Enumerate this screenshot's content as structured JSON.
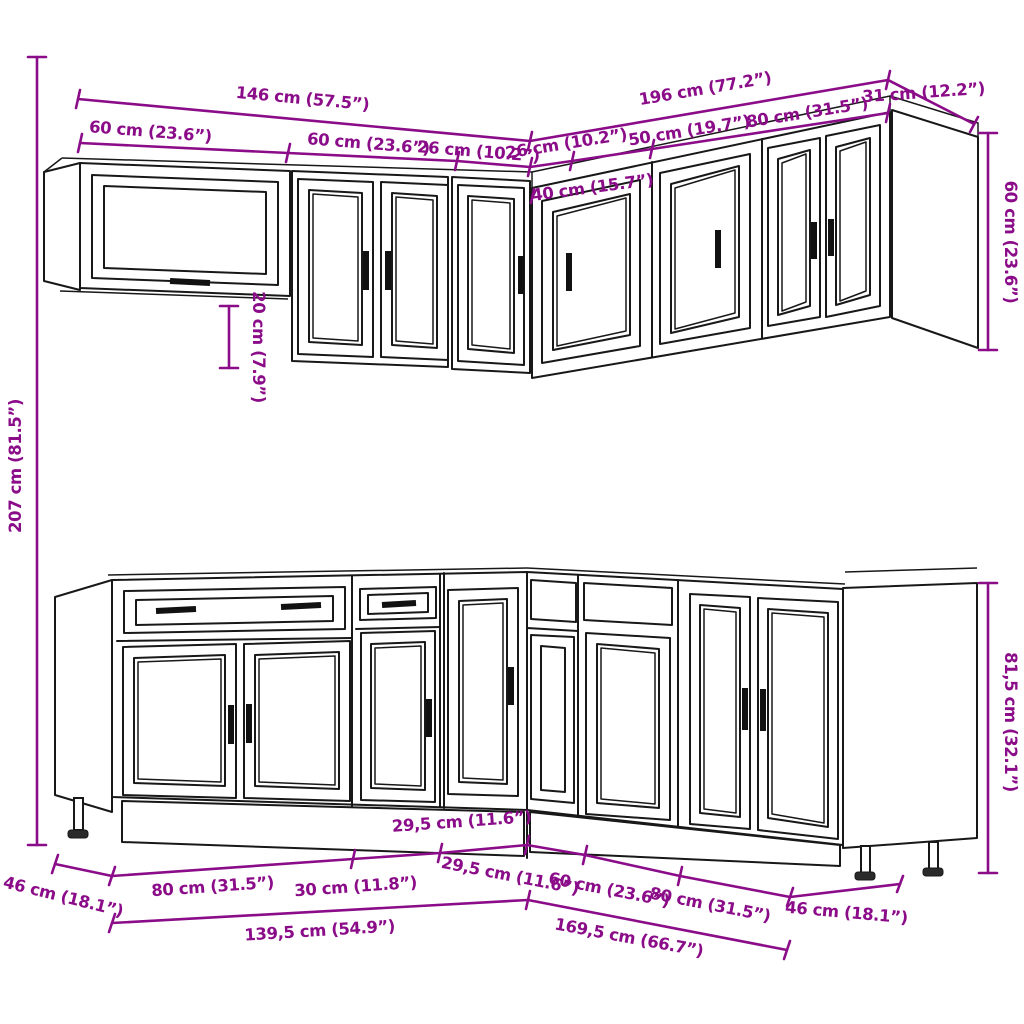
{
  "colors": {
    "background": "#ffffff",
    "drawing_line": "#181818",
    "dimension": "#8b0c88"
  },
  "upper_cabinets": {
    "total_width_left": "146 cm (57.5”)",
    "total_width_right": "196 cm (77.2”)",
    "right_end_depth": "31 cm (12.2”)",
    "left_segments": [
      "60 cm (23.6”)",
      "60 cm (23.6”)",
      "26 cm (10.2”)"
    ],
    "right_segments": [
      "26 cm (10.2”)",
      "50 cm (19.7”)",
      "80 cm (31.5”)"
    ],
    "corner_cabinet_width": "40 cm (15.7”)",
    "cabinet_height": "60 cm (23.6”)",
    "glass_cabinet_height_offset": "20 cm (7.9”)"
  },
  "base_cabinets": {
    "cabinet_height": "81,5 cm (32.1”)",
    "left_end_depth": "46 cm (18.1”)",
    "right_end_depth": "46 cm (18.1”)",
    "left_segments": [
      "80 cm (31.5”)",
      "30 cm (11.8”)",
      "29,5 cm (11.6”)"
    ],
    "right_segments": [
      "29,5 cm (11.6”)",
      "60 cm (23.6”)",
      "80 cm (31.5”)"
    ],
    "total_width_left": "139,5 cm (54.9”)",
    "total_width_right": "169,5 cm (66.7”)"
  },
  "overall": {
    "total_height": "207 cm (81.5”)"
  }
}
